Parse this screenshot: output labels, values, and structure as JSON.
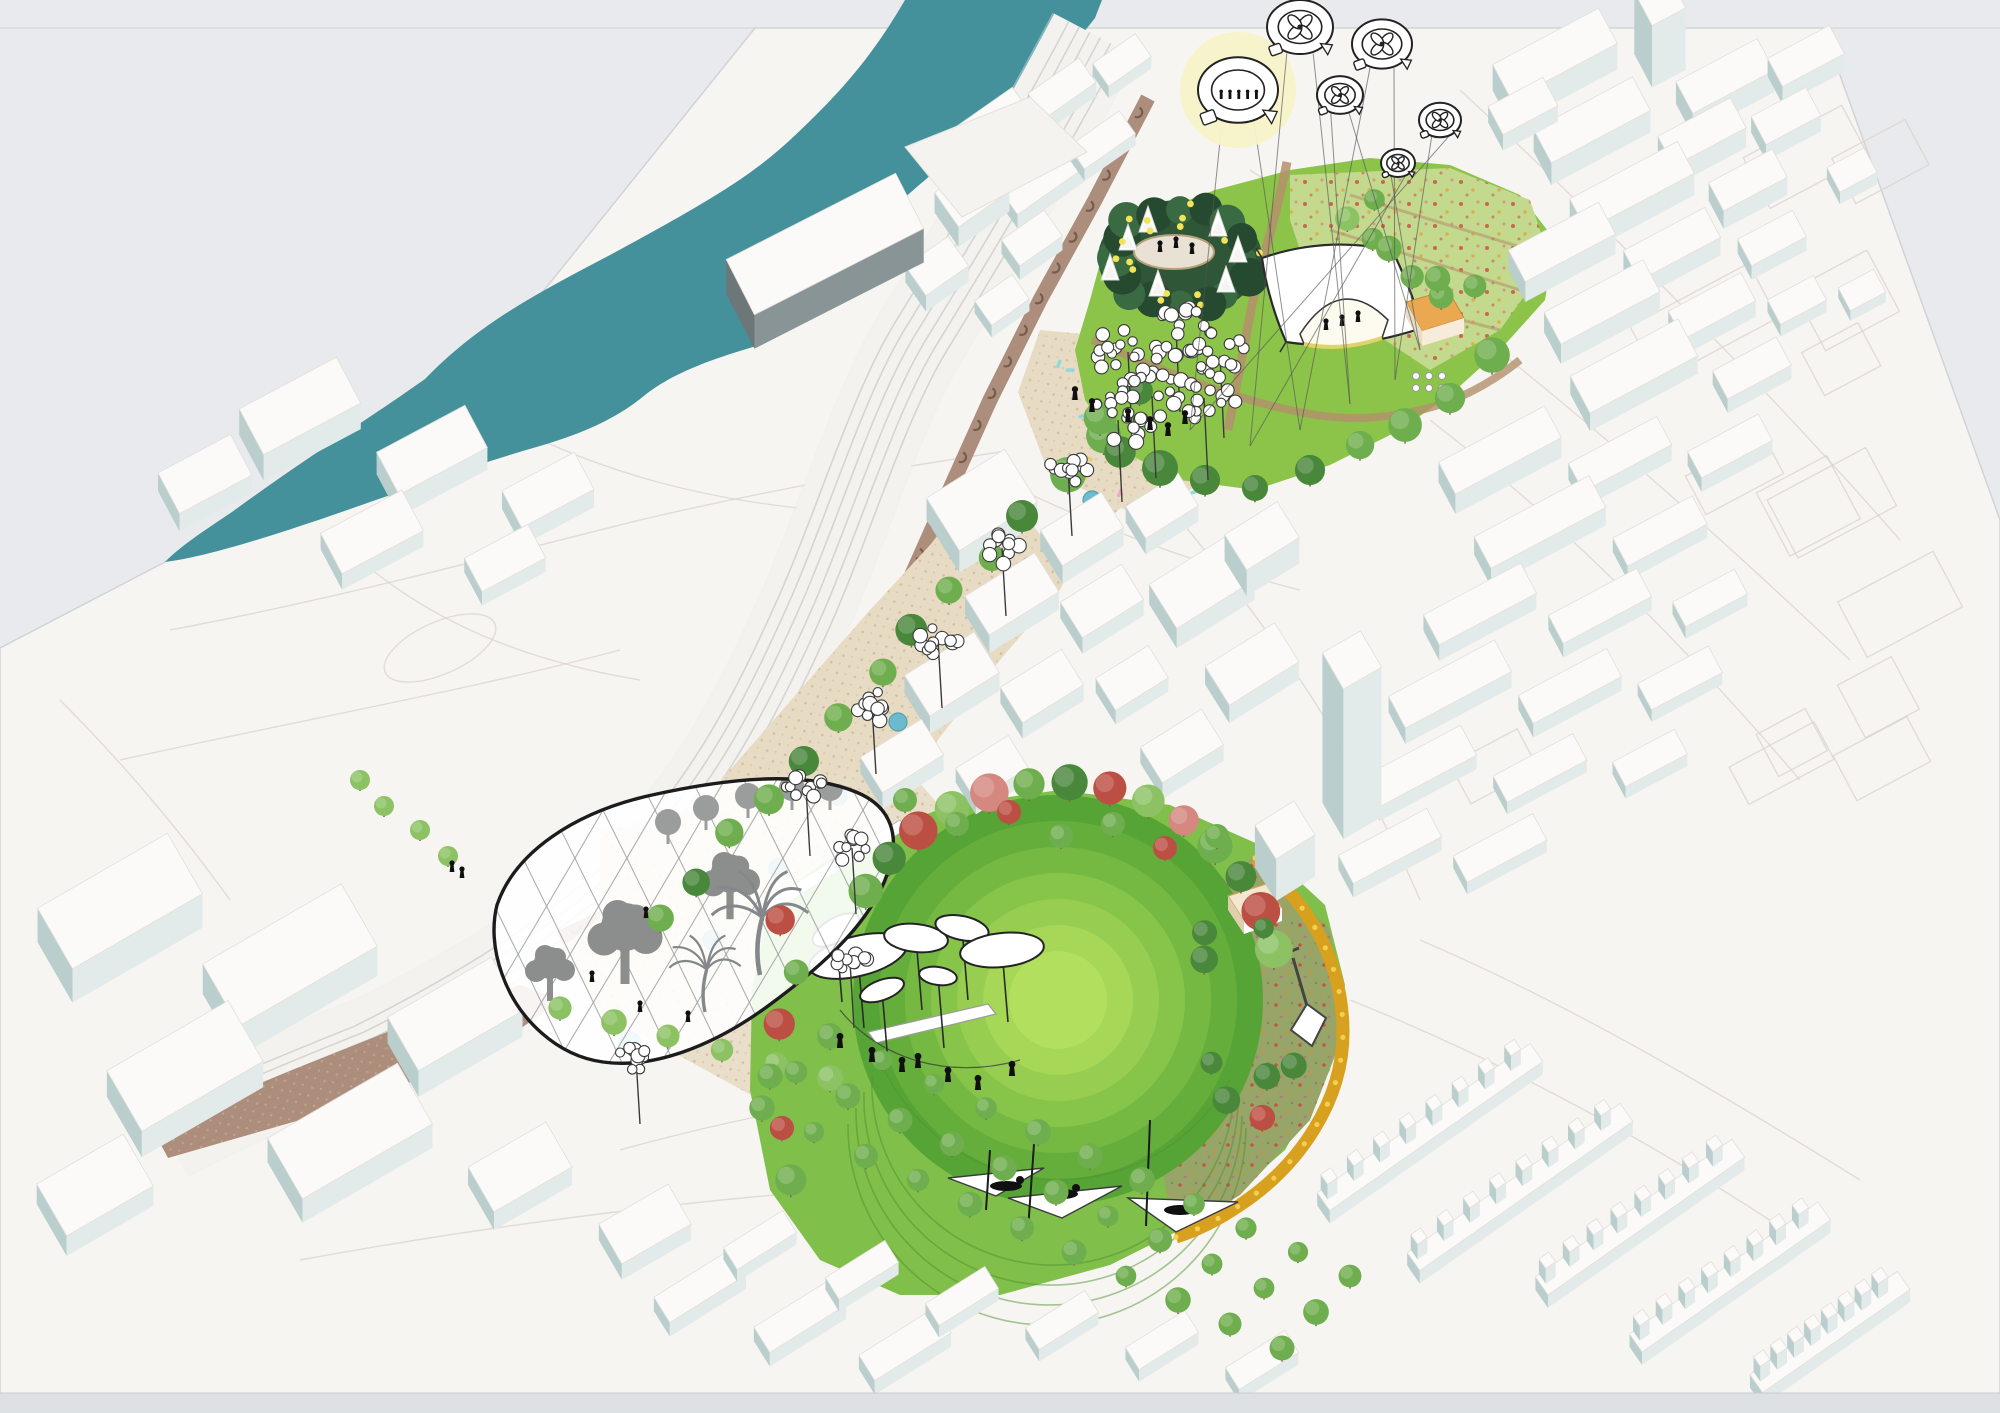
{
  "scene": {
    "title": "Aerial axonometric masterplan rendering: riverside city with linear park over a railway corridor",
    "style": "white massing model with illustrated landscape"
  },
  "colors": {
    "paper": "#e9eaed",
    "plan": "#f7f5f2",
    "plan_edge": "#d2d3d7",
    "linework": "#d9d3cc",
    "river": "#44919b",
    "rail_bed": "#f8f7f4",
    "rail_line": "#d2d0cd",
    "viaduct": "#a98876",
    "viaduct_dark": "#6f5848",
    "paving": "#e7dbc4",
    "paving_dot": "#cdb795",
    "path": "#b3906b",
    "lawn": "#8cc44a",
    "lawn_deep": "#5aa235",
    "meadow": "#c3d98d",
    "meadow_dot1": "#cf5244",
    "meadow_dot2": "#e0a23e",
    "pollinator": "#97a568",
    "conifer": "#2f5637",
    "conifer_dark": "#264a2f",
    "tree": "#6fae4e",
    "tree_dark": "#49873b",
    "tree_light": "#8cc263",
    "flowering": "#bc4f43",
    "flowering_light": "#d4887f",
    "gold": "#d7a01f",
    "gold_dot": "#f3cf4e",
    "pool_blue": "#5fb7cf",
    "confetti_pink": "#f2a6c6",
    "confetti_cyan": "#8fd8de",
    "confetti_yellow": "#edc96d",
    "balloon_glow": "#f7f2c8",
    "white": "#ffffff",
    "ink": "#2a2a2a",
    "people": "#101010",
    "bldg_top": "#fbfaf8",
    "bldg_front": "#e3ebea",
    "bldg_side": "#b9cecd",
    "bldg_dark": "#6d7678",
    "bldg_stroke": "#e2dfda",
    "orange": "#eaa850",
    "bottom_strip": "#dee1e4"
  },
  "features": {
    "river": {
      "name": "river"
    },
    "railway": {
      "name": "railway-corridor",
      "track_count": 6
    },
    "viaduct": {
      "name": "brick-arch-viaduct",
      "arch_count": 30
    },
    "boulevard": {
      "name": "tree-lined-boulevard",
      "tree_count": 14,
      "pool_count": 8,
      "lantern_count": 5,
      "confetti_count": 20
    },
    "upper_park": {
      "name": "north-event-park",
      "elements": [
        "conifer-grove",
        "ice-rink",
        "white-cone-trees",
        "fairy-lights",
        "tensile-canopy-stage",
        "wildflower-meadow",
        "orange-pavilion",
        "bubble-canopy-cluster",
        "cafe-terrace"
      ]
    },
    "balloons": {
      "name": "tethered-observation-balloons",
      "items": [
        {
          "icon": "people-viewing-deck",
          "highlight": true
        },
        {
          "icon": "four-petal-rotor"
        },
        {
          "icon": "four-petal-rotor"
        },
        {
          "icon": "four-petal-rotor"
        },
        {
          "icon": "four-petal-rotor"
        },
        {
          "icon": "four-petal-rotor"
        }
      ]
    },
    "greenhouse": {
      "name": "winter-garden-glass-canopy",
      "contents": [
        "palm-silhouettes",
        "tree-silhouettes",
        "visitors"
      ]
    },
    "lower_park": {
      "name": "great-lawn-bowl-park",
      "elements": [
        "terraced-lawn-bowl",
        "petal-canopies",
        "hammock-grove",
        "pollinator-meadow",
        "golden-ribbon-wall",
        "spade-sculpture",
        "tree-bosque",
        "white-ramp"
      ],
      "bowl_rings": [
        "#57a436",
        "#66ae3c",
        "#76b942",
        "#87c44a",
        "#97ce51",
        "#a6d757",
        "#b3df5e"
      ],
      "bosque_tree_count": 33
    },
    "city": {
      "clusters": [
        "north-east-blocks",
        "east-blocks",
        "centre-blocks",
        "south-east-terraces",
        "south-west-boxes",
        "riverside-blocks",
        "station-roofs"
      ],
      "tower": "residential-tower"
    }
  }
}
